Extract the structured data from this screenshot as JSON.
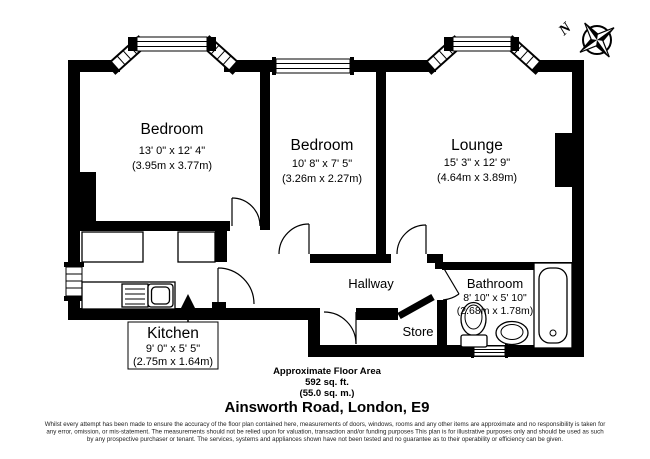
{
  "compass": {
    "north_label": "N"
  },
  "rooms": {
    "bedroom1": {
      "name": "Bedroom",
      "dims_imperial": "13' 0\" x 12' 4\"",
      "dims_metric": "(3.95m x 3.77m)"
    },
    "bedroom2": {
      "name": "Bedroom",
      "dims_imperial": "10' 8\" x 7' 5\"",
      "dims_metric": "(3.26m x 2.27m)"
    },
    "lounge": {
      "name": "Lounge",
      "dims_imperial": "15' 3\" x 12' 9\"",
      "dims_metric": "(4.64m x 3.89m)"
    },
    "bathroom": {
      "name": "Bathroom",
      "dims_imperial": "8' 10\" x 5' 10\"",
      "dims_metric": "(2.68m x 1.78m)"
    },
    "kitchen": {
      "name": "Kitchen",
      "dims_imperial": "9' 0\" x 5' 5\"",
      "dims_metric": "(2.75m x 1.64m)"
    },
    "hallway": {
      "name": "Hallway"
    },
    "store": {
      "name": "Store"
    }
  },
  "footer": {
    "area_heading": "Approximate Floor Area",
    "area_sqft": "592 sq. ft.",
    "area_sqm": "(55.0 sq. m.)",
    "address": "Ainsworth Road, London, E9",
    "disclaimer_line1": "Whilst every attempt has been made to ensure the accuracy of the floor plan contained here, measurements of doors, windows, rooms and any other items are approximate and no responsibility is taken for",
    "disclaimer_line2": "any error, omission, or mis-statement. The measurements should not be relied upon for valuation, transaction and/or funding purposes This plan is for illustrative purposes only and should be used as such",
    "disclaimer_line3": "by any prospective purchaser or tenant. The services, systems and appliances shown have not been tested and no guarantee as to their operability or efficiency can be given."
  },
  "colors": {
    "wall": "#000000",
    "background": "#ffffff"
  }
}
